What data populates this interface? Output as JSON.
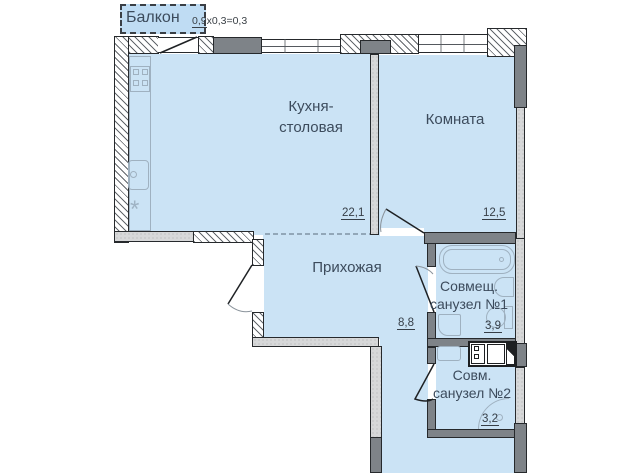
{
  "title": "floor-plan",
  "colors": {
    "room_fill": "#cbe3f5",
    "balcony_fill": "#bfdcf3",
    "wall_dark": "#26292c",
    "label_text": "#3c4b5c"
  },
  "balcony": {
    "label": "Балкон",
    "calc_underlined": "0,9",
    "calc_rest": "х0,3=0,3"
  },
  "rooms": {
    "kitchen": {
      "name_line1": "Кухня-",
      "name_line2": "столовая",
      "area": "22,1"
    },
    "living": {
      "name": "Комната",
      "area": "12,5"
    },
    "hall": {
      "name": "Прихожая",
      "area": "8,8"
    },
    "bath1": {
      "name_line1": "Совмещ.",
      "name_line2": "санузел №1",
      "area": "3,9"
    },
    "bath2": {
      "name_line1": "Совм.",
      "name_line2": "санузел №2",
      "area": "3,2"
    }
  }
}
